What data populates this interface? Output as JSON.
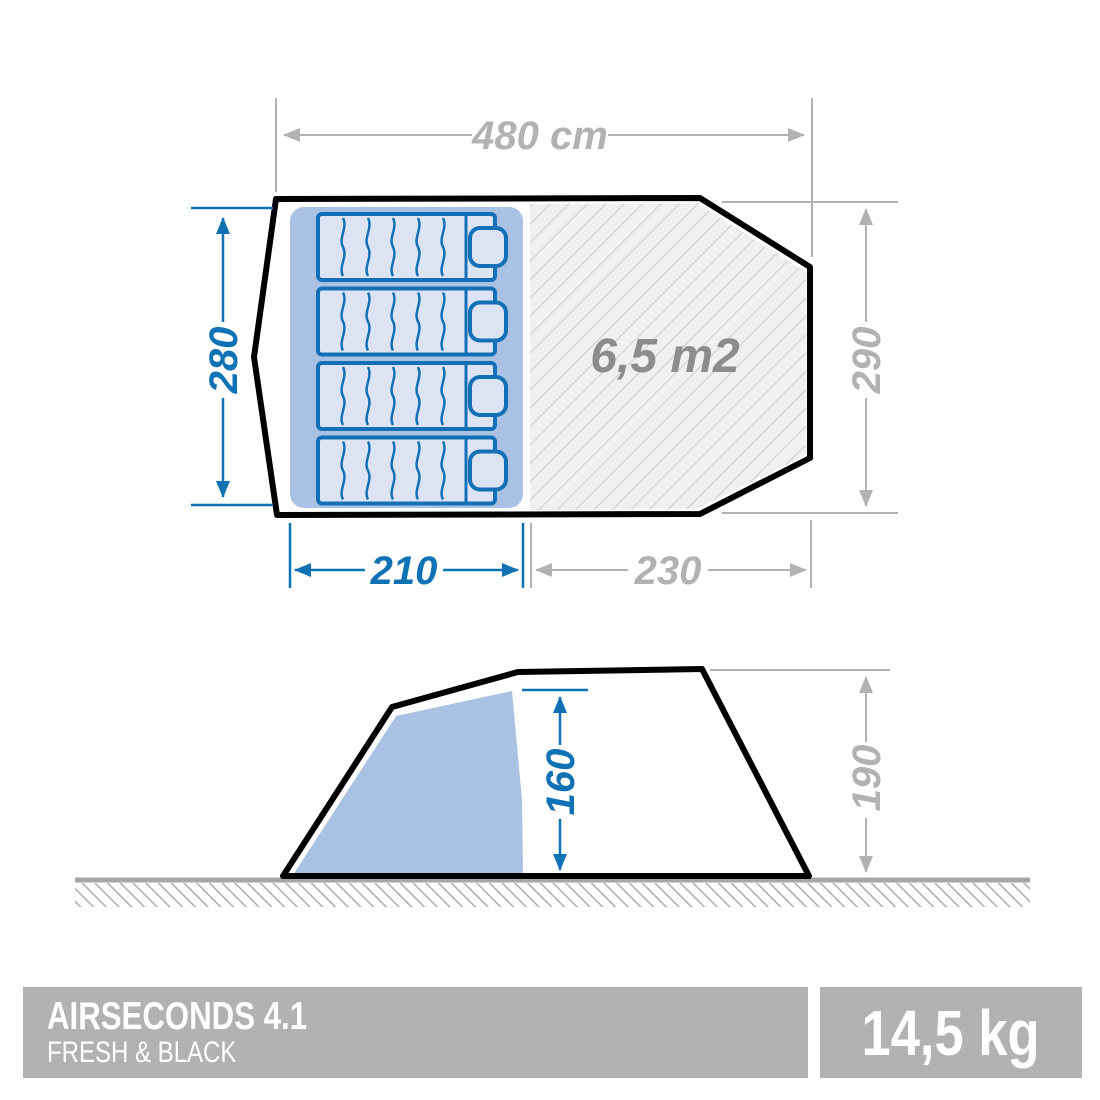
{
  "colors": {
    "blue": "#0f72b5",
    "dim_gray": "#b2b2b2",
    "area_gray": "#8c8c8c",
    "sleep": "#a9c2e3",
    "mattress": "#dce4f4",
    "mattress_stroke": "#1470b6",
    "hatch_bg": "#f0f0f0",
    "hatch_line": "#cbcbcb",
    "ground_line": "#a6a6a6",
    "ground_hatch": "#adadad",
    "outline": "#000000",
    "bar_bg": "#b2b2b2",
    "bar_text": "#ffffff"
  },
  "floor_plan": {
    "total_width_label": "480 cm",
    "bedroom_depth_label": "280",
    "tent_depth_label": "290",
    "bedroom_width_label": "210",
    "living_width_label": "230",
    "living_area_label": "6,5 m2",
    "bed_count": 4
  },
  "side_view": {
    "inner_height_label": "160",
    "outer_height_label": "190"
  },
  "footer": {
    "product_name": "AIRSECONDS 4.1",
    "product_subtitle": "FRESH & BLACK",
    "weight_label": "14,5 kg"
  }
}
